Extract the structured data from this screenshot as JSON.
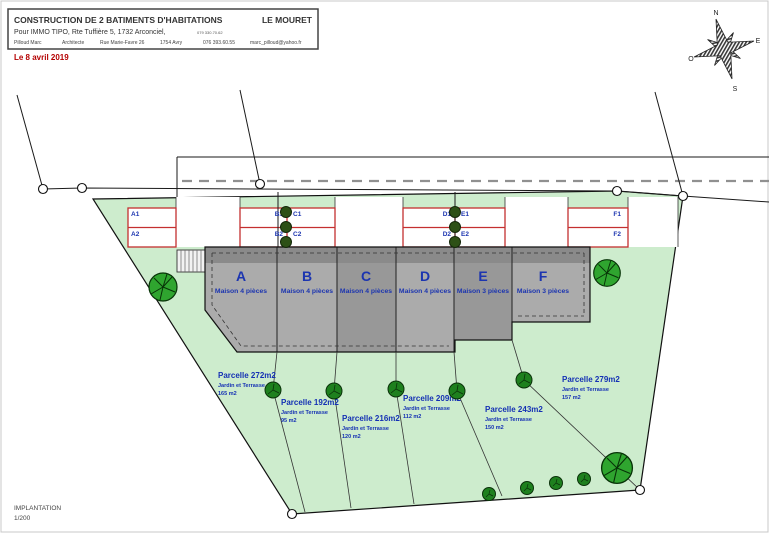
{
  "header": {
    "title": "CONSTRUCTION DE 2 BATIMENTS D'HABITATIONS",
    "location": "LE MOURET",
    "client": "Pour IMMO TIPO, Rte Tuffière 5, 1732 Arconciel,",
    "client_phone": "079 330.70.62",
    "architect_name": "Pilloud Marc",
    "architect_role": "Architecte",
    "architect_street": "Rue Marie-Favre 26",
    "architect_city": "1754 Avry",
    "architect_phone": "076 393.60.55",
    "architect_email": "marc_pilloud@yahoo.fr",
    "date": "Le 8 avril 2019"
  },
  "compass": {
    "north": "N",
    "east": "E",
    "south": "S",
    "west": "O"
  },
  "units": [
    {
      "id": "A",
      "type": "Maison 4 pièces"
    },
    {
      "id": "B",
      "type": "Maison 4 pièces"
    },
    {
      "id": "C",
      "type": "Maison 4 pièces"
    },
    {
      "id": "D",
      "type": "Maison 4 pièces"
    },
    {
      "id": "E",
      "type": "Maison 3 pièces"
    },
    {
      "id": "F",
      "type": "Maison 3 pièces"
    }
  ],
  "parking": {
    "labels": [
      "A1",
      "A2",
      "B1",
      "B2",
      "C1",
      "C2",
      "D1",
      "D2",
      "E1",
      "E2",
      "F1",
      "F2"
    ]
  },
  "parcels": [
    {
      "name": "Parcelle 272m2",
      "sub": "Jardin et Terrasse",
      "area": "165 m2"
    },
    {
      "name": "Parcelle 192m2",
      "sub": "Jardin et Terrasse",
      "area": "95 m2"
    },
    {
      "name": "Parcelle 216m2",
      "sub": "Jardin et Terrasse",
      "area": "120 m2"
    },
    {
      "name": "Parcelle 209m2",
      "sub": "Jardin et Terrasse",
      "area": "112 m2"
    },
    {
      "name": "Parcelle 243m2",
      "sub": "Jardin et Terrasse",
      "area": "150 m2"
    },
    {
      "name": "Parcelle 279m2",
      "sub": "Jardin et Terrasse",
      "area": "157 m2"
    }
  ],
  "footer": {
    "label": "IMPLANTATION",
    "scale": "1/200"
  },
  "colors": {
    "site_green": "#cdeccd",
    "building_gray": "#ababab",
    "building_dark_gray": "#8a8a8a",
    "unit_dark_gray": "#989898",
    "parking_outline_red": "#c43030",
    "label_blue": "#1430b4",
    "date_red": "#b40000",
    "tree_green": "#2fa52f",
    "bush_green": "#1e801e"
  }
}
